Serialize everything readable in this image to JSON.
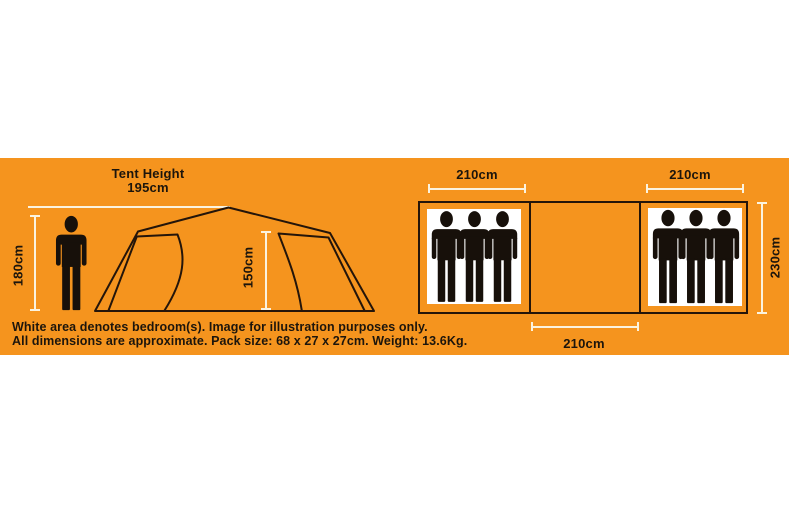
{
  "colors": {
    "band_orange": "#F5941E",
    "outline_dark": "#24150A",
    "cream": "#FBF3DF",
    "ink": "#1C150C"
  },
  "side_view": {
    "title_line1": "Tent Height",
    "title_line2": "195cm",
    "person_height_label": "180cm",
    "inner_height_label": "150cm"
  },
  "floor_plan": {
    "left_bedroom_width_label": "210cm",
    "right_bedroom_width_label": "210cm",
    "middle_width_label": "210cm",
    "depth_label": "230cm",
    "people_per_bedroom": 3
  },
  "caption": {
    "line1": "White area denotes bedroom(s). Image for illustration purposes only.",
    "line2": "All dimensions are approximate. Pack size: 68 x 27 x 27cm. Weight: 13.6Kg."
  }
}
